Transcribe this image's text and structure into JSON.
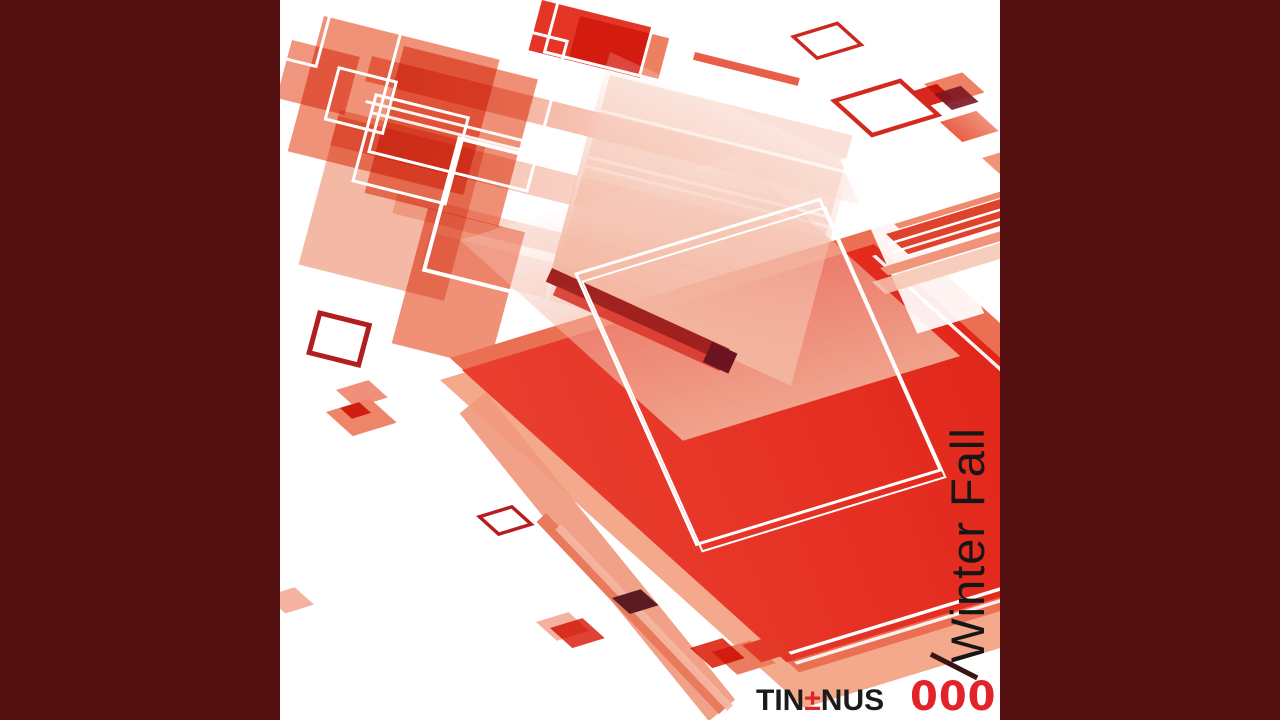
{
  "cover": {
    "title": "Winter Fall",
    "brand_pre": "TIN",
    "brand_plusminus": "±",
    "brand_post": "NUS",
    "catalog_number": "0001"
  },
  "palette": {
    "letterbox_maroon": "#551112",
    "canvas_white": "#ffffff",
    "primary_red": "#e4281d",
    "salmon": "#ec7a5c",
    "light_pink": "#f5b9a6",
    "title_black": "#161616",
    "catalog_red": "#e1232a",
    "plusminus_red": "#d8262b",
    "dark_wine": "#5a1b22"
  },
  "shapes": [
    {
      "name": "pale-bar-1",
      "cls": "fb",
      "x": 92,
      "y": 56,
      "w": 560,
      "h": 26,
      "bg": "linear-gradient(to right, rgba(240,144,115,0.9), rgba(253,238,233,0.15))"
    },
    {
      "name": "pale-bar-2",
      "cls": "fb",
      "x": 58,
      "y": 116,
      "w": 640,
      "h": 30,
      "bg": "linear-gradient(to right, rgba(242,167,143,0.85), rgba(255,255,255,0.15))"
    },
    {
      "name": "pale-bar-3",
      "cls": "fb",
      "x": 118,
      "y": 192,
      "w": 560,
      "h": 22,
      "bg": "linear-gradient(to right, rgba(247,197,180,0.8), rgba(255,255,255,0.12))"
    },
    {
      "name": "pale-bar-4",
      "cls": "fb",
      "x": 150,
      "y": 232,
      "w": 560,
      "h": 38,
      "bg": "linear-gradient(to right, rgba(249,214,202,0.6), rgba(255,255,255,0.08))"
    },
    {
      "name": "cluster-salmon-1",
      "cls": "fb",
      "x": 44,
      "y": 16,
      "w": 181,
      "h": 140,
      "bg": "#ef8669",
      "op": 0.9,
      "blend": "multiply"
    },
    {
      "name": "cluster-salmon-2",
      "cls": "fb",
      "x": 124,
      "y": 46,
      "w": 138,
      "h": 152,
      "bg": "#ec7c5e",
      "op": 0.85,
      "blend": "multiply"
    },
    {
      "name": "cluster-salmon-3",
      "cls": "fb",
      "x": 60,
      "y": 110,
      "w": 150,
      "h": 160,
      "bg": "#f2a78f",
      "op": 0.8,
      "blend": "multiply"
    },
    {
      "name": "cluster-salmon-4",
      "cls": "fb",
      "x": 148,
      "y": 208,
      "w": 100,
      "h": 140,
      "bg": "#ee8468",
      "op": 0.9,
      "blend": "multiply"
    },
    {
      "name": "cluster-salmon-left",
      "cls": "fb",
      "x": 12,
      "y": 40,
      "w": 70,
      "h": 60,
      "bg": "#ee8468",
      "op": 0.85,
      "blend": "multiply"
    },
    {
      "name": "top-red-square",
      "cls": "fb",
      "x": 262,
      "y": 0,
      "w": 115,
      "h": 52,
      "bg": "#e43527"
    },
    {
      "name": "top-salmon-square",
      "cls": "fb",
      "x": 300,
      "y": 16,
      "w": 92,
      "h": 42,
      "bg": "#ed8061",
      "blend": "multiply"
    },
    {
      "name": "top-thin-red-bar",
      "cls": "fb",
      "x": 415,
      "y": 52,
      "w": 108,
      "h": 8,
      "bg": "#e6503a",
      "op": 0.92
    },
    {
      "name": "pale-square-mid",
      "cls": "fb",
      "x": 330,
      "y": 75,
      "w": 250,
      "h": 170,
      "bg": "#f7cfc0",
      "op": 0.65
    },
    {
      "name": "white-crossline-1",
      "cls": "fb",
      "x": 86,
      "y": 100,
      "w": 600,
      "h": 3,
      "bg": "#ffffff",
      "op": 0.95
    },
    {
      "name": "white-crossline-2",
      "cls": "fb",
      "x": 91,
      "y": 111,
      "w": 600,
      "h": 3,
      "bg": "#ffffff",
      "op": 0.9
    },
    {
      "name": "white-crossline-3",
      "cls": "fb",
      "x": 300,
      "y": 104,
      "w": 420,
      "h": 3,
      "bg": "#ffffff",
      "op": 0.85
    },
    {
      "name": "white-outline-1",
      "cls": "fb",
      "x": 128,
      "y": 0,
      "w": 160,
      "h": 152,
      "border": {
        "w": 3,
        "color": "#ffffff"
      }
    },
    {
      "name": "white-outline-2",
      "cls": "fb",
      "x": 95,
      "y": 93,
      "w": 92,
      "h": 86,
      "border": {
        "w": 3,
        "color": "#ffffff"
      }
    },
    {
      "name": "white-outline-3",
      "cls": "fb",
      "x": 178,
      "y": 136,
      "w": 122,
      "h": 132,
      "border": {
        "w": 4,
        "color": "#ffffff"
      }
    },
    {
      "name": "white-outline-4",
      "cls": "fb",
      "x": 58,
      "y": 66,
      "w": 56,
      "h": 50,
      "border": {
        "w": 3,
        "color": "#ffffff"
      }
    },
    {
      "name": "white-outline-5",
      "cls": "fb",
      "x": 285,
      "y": -30,
      "w": 95,
      "h": 80,
      "border": {
        "w": 3,
        "color": "#ffffff"
      }
    },
    {
      "name": "white-outline-corner",
      "cls": "fb",
      "x": -20,
      "y": -12,
      "w": 70,
      "h": 58,
      "border": {
        "w": 3,
        "color": "#ffffff"
      }
    },
    {
      "name": "red-backing-light",
      "cls": "fa",
      "x": 160,
      "y": 380,
      "w": 480,
      "h": 490,
      "bg": "#f4a88c"
    },
    {
      "name": "red-backing",
      "cls": "fa",
      "x": 170,
      "y": 358,
      "w": 460,
      "h": 470,
      "bg": "#eb6f53"
    },
    {
      "name": "main-red-square",
      "cls": "fa",
      "x": 182,
      "y": 370,
      "w": 431,
      "h": 437,
      "bg": "linear-gradient(115deg, #ea3f30, #df2115)"
    },
    {
      "name": "pink-overlay-right",
      "cls": "fa",
      "x": 180,
      "y": 240,
      "w": 290,
      "h": 300,
      "bg": "linear-gradient(to top, rgba(240,166,143,0.97), rgba(255,246,243,0.22))"
    },
    {
      "name": "pink-overlay-left",
      "cls": "fbp",
      "x": 330,
      "y": 52,
      "w": 265,
      "h": 232,
      "bg": "linear-gradient(to top, rgba(243,181,159,0.97), rgba(255,255,255,0.18))"
    },
    {
      "name": "dark-red-band",
      "cls": "r26",
      "x": 272,
      "y": 268,
      "w": 195,
      "h": 15,
      "bg": "#9c1c1a",
      "op": 0.96
    },
    {
      "name": "red-band-strip",
      "cls": "r26",
      "x": 277,
      "y": 286,
      "w": 183,
      "h": 10,
      "bg": "#d7382e",
      "op": 0.9
    },
    {
      "name": "dark-band-end-block",
      "cls": "r26",
      "x": 432,
      "y": 342,
      "w": 28,
      "h": 22,
      "bg": "#6b1420"
    },
    {
      "name": "white-streak",
      "cls": "fc",
      "x": 560,
      "y": 160,
      "w": 70,
      "h": 190,
      "bg": "rgba(255,255,255,0.92)"
    },
    {
      "name": "inner-white-outline-a",
      "cls": "fc",
      "x": 294,
      "y": 273,
      "w": 252,
      "h": 293,
      "border": {
        "w": 3,
        "color": "#ffffff"
      }
    },
    {
      "name": "inner-white-outline-b",
      "cls": "fc",
      "x": 301,
      "y": 281,
      "w": 252,
      "h": 293,
      "border": {
        "w": 2,
        "color": "#ffffff"
      }
    },
    {
      "name": "white-edge-line-right",
      "cls": "fa",
      "x": 592,
      "y": 256,
      "w": 4,
      "h": 290,
      "bg": "#ffffff",
      "op": 0.95
    },
    {
      "name": "white-edge-line-bottom-1",
      "cls": "fa",
      "x": 508,
      "y": 652,
      "w": 230,
      "h": 4,
      "bg": "#ffffff"
    },
    {
      "name": "white-edge-line-bottom-2",
      "cls": "fa",
      "x": 514,
      "y": 662,
      "w": 230,
      "h": 4,
      "bg": "#ffffff",
      "op": 0.9
    },
    {
      "name": "stripe-pale",
      "cls": "fa",
      "x": 592,
      "y": 282,
      "w": 140,
      "h": 18,
      "bg": "#f6c5b2",
      "op": 0.85
    },
    {
      "name": "stripe-salmon",
      "cls": "fa",
      "x": 600,
      "y": 268,
      "w": 135,
      "h": 11,
      "bg": "#f09579"
    },
    {
      "name": "stripe-red",
      "cls": "fa",
      "x": 606,
      "y": 234,
      "w": 130,
      "h": 30,
      "bg": "#df432c"
    },
    {
      "name": "stripe-white-line-1",
      "cls": "fa",
      "x": 607,
      "y": 243,
      "w": 130,
      "h": 3,
      "bg": "#ffffff"
    },
    {
      "name": "stripe-white-line-2",
      "cls": "fa",
      "x": 609,
      "y": 252,
      "w": 130,
      "h": 3,
      "bg": "#ffffff",
      "op": 0.95
    },
    {
      "name": "stripe-salmon-thin",
      "cls": "fa",
      "x": 614,
      "y": 224,
      "w": 120,
      "h": 7,
      "bg": "#ef8a6d"
    },
    {
      "name": "tr-salmon-1",
      "cls": "fa",
      "x": 644,
      "y": 84,
      "w": 40,
      "h": 30,
      "bg": "#ee8164"
    },
    {
      "name": "tr-red",
      "cls": "fa",
      "x": 630,
      "y": 92,
      "w": 28,
      "h": 22,
      "bg": "#d8271e",
      "blend": "multiply"
    },
    {
      "name": "tr-dark-square",
      "cls": "fa",
      "x": 654,
      "y": 94,
      "w": 28,
      "h": 24,
      "bg": "#7c1522",
      "op": 0.9
    },
    {
      "name": "tr-salmon-2",
      "cls": "fa",
      "x": 660,
      "y": 122,
      "w": 38,
      "h": 30,
      "bg": "linear-gradient(to right, #e96046, #f0907a)"
    },
    {
      "name": "tr-salmon-edge",
      "cls": "fa",
      "x": 702,
      "y": 158,
      "w": 34,
      "h": 26,
      "bg": "#f09579"
    },
    {
      "name": "tr-outline-small",
      "cls": "fa",
      "x": 510,
      "y": 36,
      "w": 42,
      "h": 28,
      "border": {
        "w": 4,
        "color": "#cb2820"
      }
    },
    {
      "name": "tr-outline-large",
      "cls": "fa",
      "x": 550,
      "y": 100,
      "w": 64,
      "h": 46,
      "border": {
        "w": 5,
        "color": "#d32a20"
      }
    },
    {
      "name": "ml-outline",
      "cls": "fb",
      "x": 38,
      "y": 310,
      "w": 46,
      "h": 36,
      "border": {
        "w": 5,
        "color": "#b01e1f"
      }
    },
    {
      "name": "ml-salmon-small",
      "cls": "fa",
      "x": 56,
      "y": 390,
      "w": 34,
      "h": 26,
      "bg": "#f0907a"
    },
    {
      "name": "ml-salmon-large",
      "cls": "fa",
      "x": 46,
      "y": 412,
      "w": 46,
      "h": 36,
      "bg": "#ee8468"
    },
    {
      "name": "ml-red-overlap",
      "cls": "fa",
      "x": 60,
      "y": 408,
      "w": 20,
      "h": 16,
      "bg": "#dd3c28",
      "blend": "multiply"
    },
    {
      "name": "left-edge-salmon",
      "cls": "fa",
      "x": -14,
      "y": 596,
      "w": 30,
      "h": 26,
      "bg": "#f4b2a0"
    },
    {
      "name": "bl-outline-small",
      "cls": "fa",
      "x": 196,
      "y": 516,
      "w": 30,
      "h": 22,
      "border": {
        "w": 4,
        "color": "#b51d20"
      }
    },
    {
      "name": "wide-light-bar",
      "cls": "r51",
      "x": 206,
      "y": 392,
      "w": 396,
      "h": 34,
      "bg": "#f0997d",
      "op": 0.92
    },
    {
      "name": "thin-salmon-bar",
      "cls": "r46",
      "x": 266,
      "y": 513,
      "w": 265,
      "h": 13,
      "bg": "#e97a5c"
    },
    {
      "name": "thin-light-strip",
      "cls": "r46",
      "x": 281,
      "y": 524,
      "w": 250,
      "h": 8,
      "bg": "#f5b8a4",
      "op": 0.9
    },
    {
      "name": "bar-dark-diamond",
      "cls": "fa",
      "x": 332,
      "y": 598,
      "w": 30,
      "h": 24,
      "bg": "#5a1b22"
    },
    {
      "name": "bl-pink-diamond",
      "cls": "fa",
      "x": 256,
      "y": 622,
      "w": 34,
      "h": 28,
      "bg": "#f5b0a0"
    },
    {
      "name": "bl-red-diamond",
      "cls": "fa",
      "x": 270,
      "y": 628,
      "w": 34,
      "h": 30,
      "bg": "#e04233",
      "blend": "multiply"
    },
    {
      "name": "zigzag-salmon",
      "cls": "fa",
      "x": 432,
      "y": 652,
      "w": 40,
      "h": 34,
      "bg": "#ec7c5f"
    },
    {
      "name": "zigzag-red-1",
      "cls": "fa",
      "x": 410,
      "y": 648,
      "w": 34,
      "h": 30,
      "bg": "#e23a28",
      "blend": "multiply"
    },
    {
      "name": "zigzag-red-2",
      "cls": "fa",
      "x": 462,
      "y": 645,
      "w": 30,
      "h": 26,
      "bg": "#e23a28"
    },
    {
      "name": "dark-thin-line",
      "cls": "r27",
      "x": 652,
      "y": 652,
      "w": 52,
      "h": 5,
      "bg": "#3a1412"
    }
  ]
}
